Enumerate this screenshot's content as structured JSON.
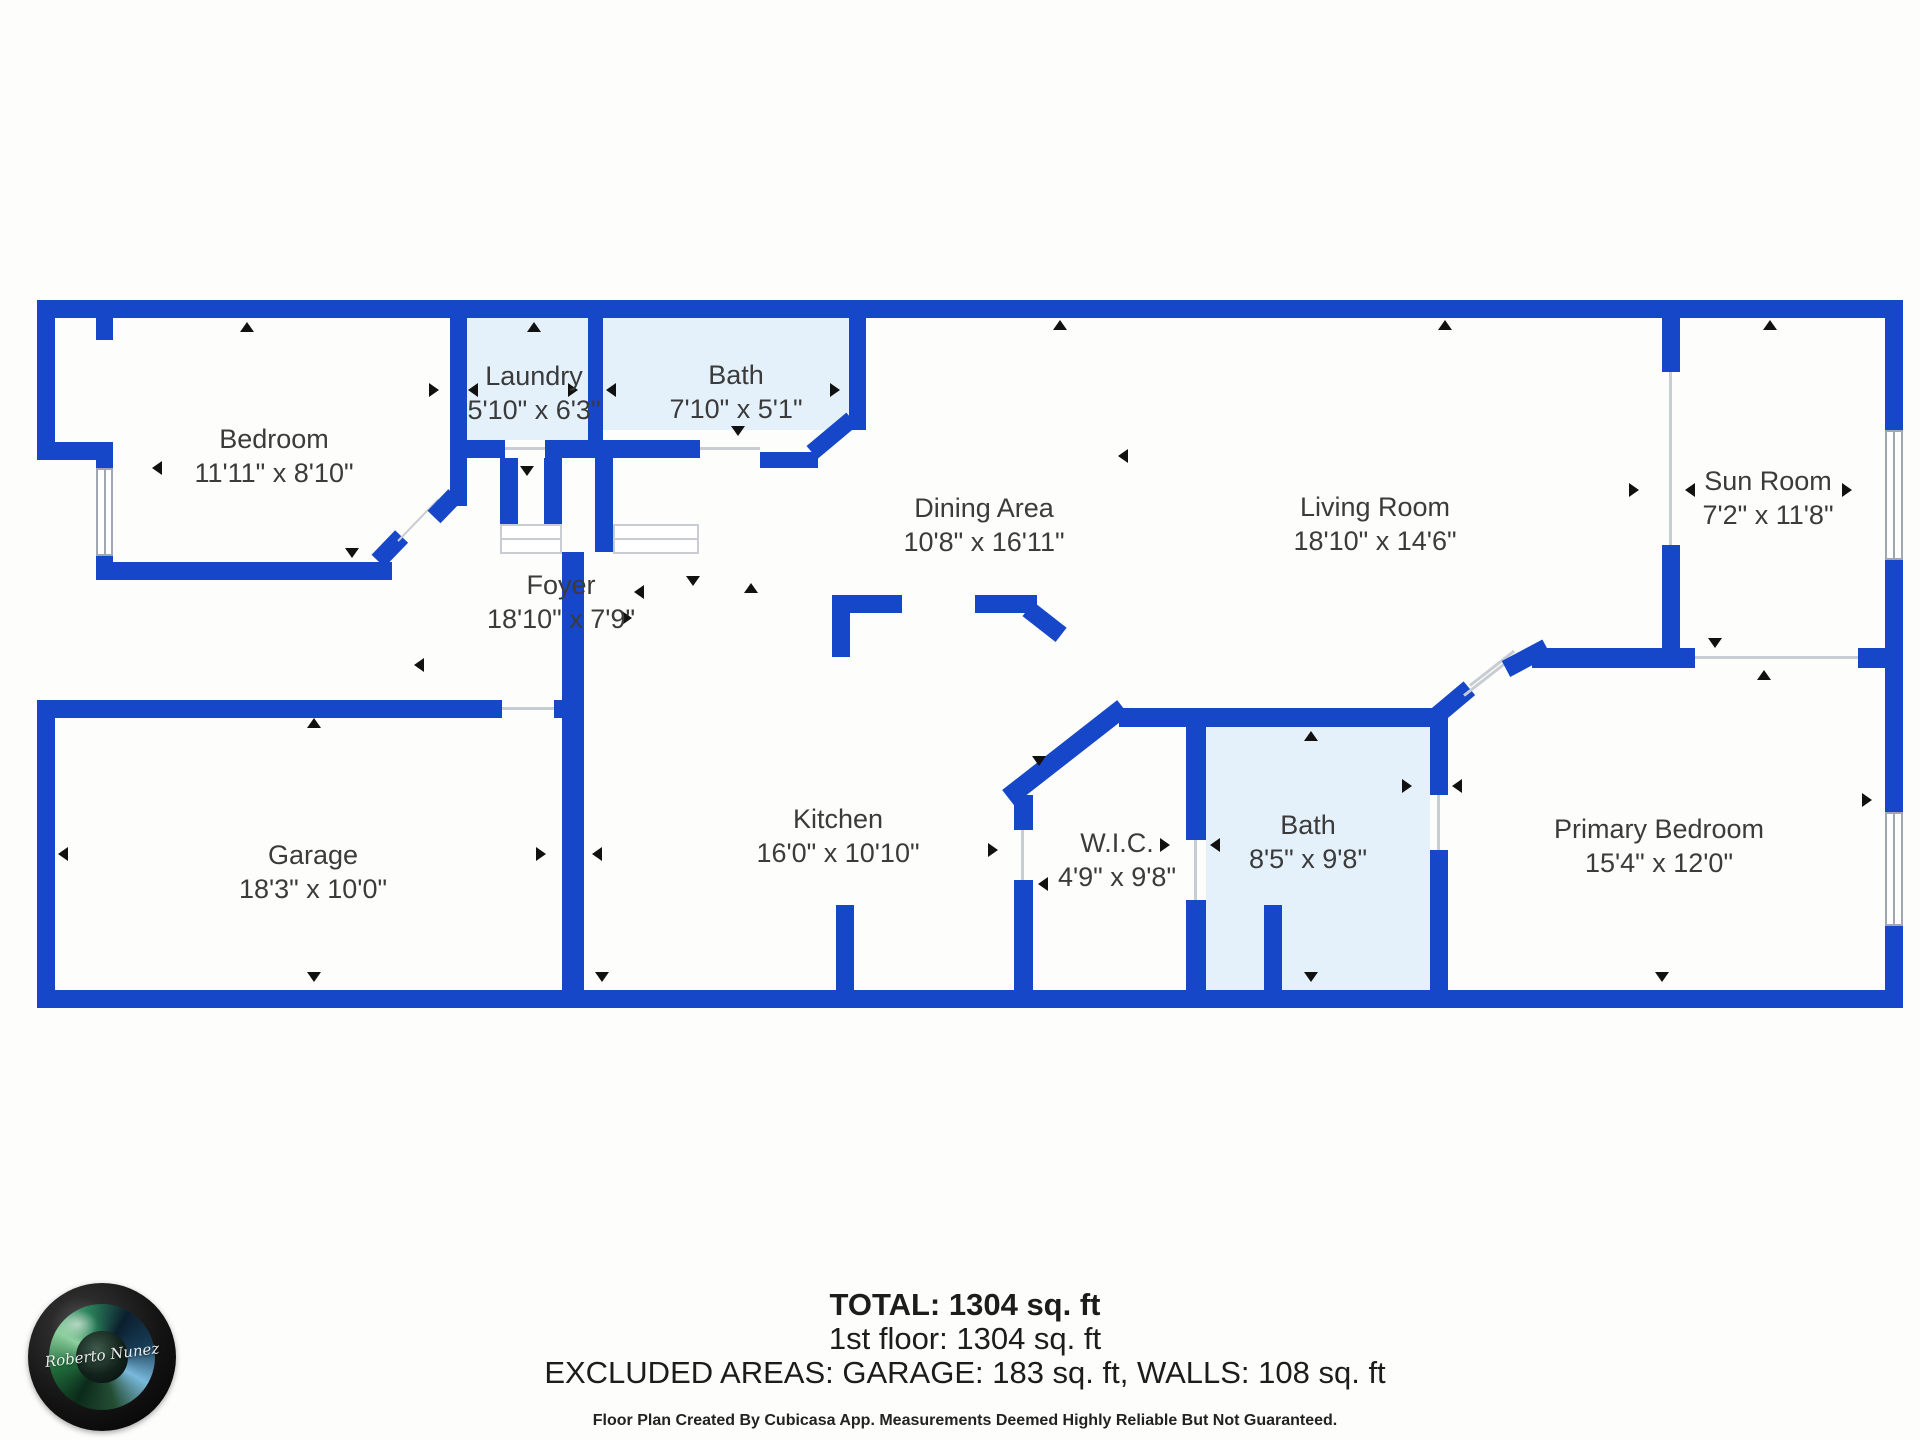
{
  "colors": {
    "wall": "#1747C9",
    "room_fill_light": "#E4F1FB",
    "page": "#FDFDFB",
    "label": "#3B3B3B"
  },
  "rooms": [
    {
      "name": "Bedroom",
      "dims": "11'11\" x 8'10\""
    },
    {
      "name": "Laundry",
      "dims": "5'10\" x 6'3\""
    },
    {
      "name": "Bath",
      "dims": "7'10\" x 5'1\""
    },
    {
      "name": "Dining Area",
      "dims": "10'8\" x 16'11\""
    },
    {
      "name": "Living Room",
      "dims": "18'10\" x 14'6\""
    },
    {
      "name": "Sun Room",
      "dims": "7'2\" x 11'8\""
    },
    {
      "name": "Foyer",
      "dims": "18'10\" x 7'9\""
    },
    {
      "name": "Garage",
      "dims": "18'3\" x 10'0\""
    },
    {
      "name": "Kitchen",
      "dims": "16'0\" x 10'10\""
    },
    {
      "name": "W.I.C.",
      "dims": "4'9\" x 9'8\""
    },
    {
      "name": "Bath",
      "dims": "8'5\" x 9'8\""
    },
    {
      "name": "Primary Bedroom",
      "dims": "15'4\" x 12'0\""
    }
  ],
  "summary": {
    "total": "TOTAL: 1304 sq. ft",
    "floor1": "1st floor: 1304 sq. ft",
    "excluded": "EXCLUDED AREAS: GARAGE: 183 sq. ft, WALLS: 108 sq. ft",
    "disclaimer": "Floor Plan Created By Cubicasa App. Measurements Deemed Highly Reliable But Not Guaranteed."
  },
  "logo": {
    "signature": "Roberto Nunez"
  }
}
